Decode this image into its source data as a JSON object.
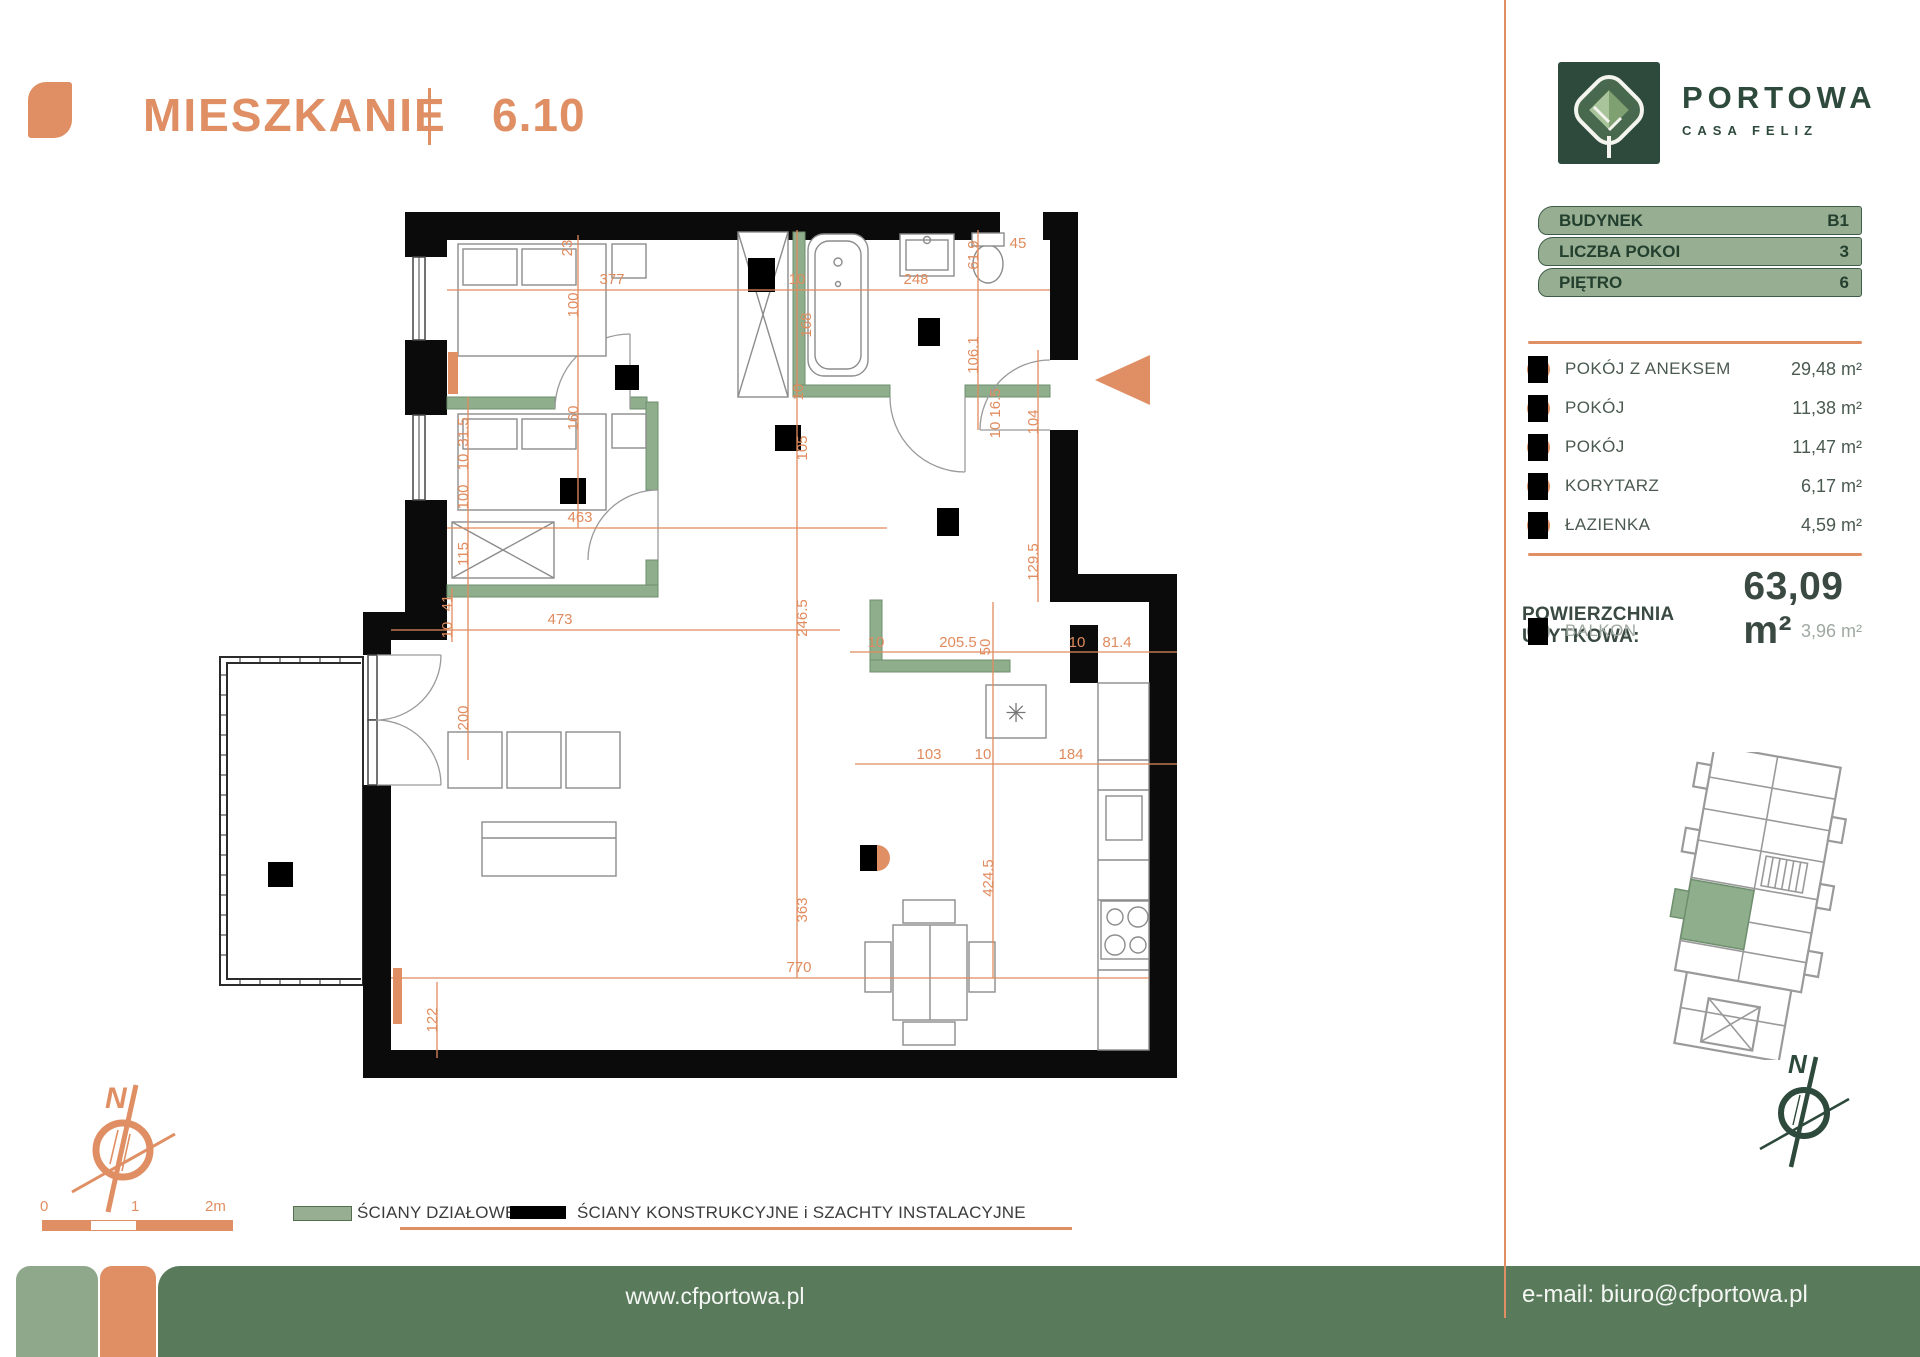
{
  "header": {
    "title": "MIESZKANIE",
    "unit": "6.10"
  },
  "logo": {
    "name": "PORTOWA",
    "subtitle": "CASA FELIZ"
  },
  "badges": {
    "items": [
      {
        "label": "BUDYNEK",
        "value": "B1"
      },
      {
        "label": "LICZBA POKOI",
        "value": "3"
      },
      {
        "label": "PIĘTRO",
        "value": "6"
      }
    ]
  },
  "rooms": {
    "items": [
      {
        "label": "POKÓJ Z ANEKSEM",
        "area": "29,48 m²"
      },
      {
        "label": "POKÓJ",
        "area": "11,38 m²"
      },
      {
        "label": "POKÓJ",
        "area": "11,47 m²"
      },
      {
        "label": "KORYTARZ",
        "area": "6,17 m²"
      },
      {
        "label": "ŁAZIENKA",
        "area": "4,59 m²"
      }
    ]
  },
  "total": {
    "label": "POWIERZCHNIA UŻYTKOWA:",
    "value": "63,09 m²"
  },
  "balcony": {
    "label": "BALKON",
    "area": "3,96 m²"
  },
  "legend": {
    "items": [
      {
        "label": "ŚCIANY DZIAŁOWE",
        "color": "#97AE92"
      },
      {
        "label": "ŚCIANY KONSTRUKCYJNE i SZACHTY INSTALACYJNE",
        "color": "#000000"
      }
    ]
  },
  "footer": {
    "website": "www.cfportowa.pl",
    "email": "e-mail: biuro@cfportowa.pl"
  },
  "compass": {
    "north": "N"
  },
  "scalebar": {
    "labels": [
      "0",
      "1",
      "2m"
    ]
  },
  "colors": {
    "accent": "#DF8F63",
    "dark_green": "#2E4A3C",
    "sage": "#97AE92",
    "footer_green": "#5A7A5C"
  },
  "floorplan": {
    "boiler_symbol": "✳",
    "dimensions": [
      {
        "t": "23",
        "x": 372,
        "y": 48,
        "v": 1
      },
      {
        "t": "377",
        "x": 412,
        "y": 84
      },
      {
        "t": "10",
        "x": 597,
        "y": 84
      },
      {
        "t": "248",
        "x": 716,
        "y": 84
      },
      {
        "t": "61.9",
        "x": 778,
        "y": 55,
        "v": 1
      },
      {
        "t": "45",
        "x": 818,
        "y": 48
      },
      {
        "t": "100",
        "x": 378,
        "y": 105,
        "v": 1
      },
      {
        "t": "160",
        "x": 378,
        "y": 218,
        "v": 1
      },
      {
        "t": "168",
        "x": 611,
        "y": 125,
        "v": 1
      },
      {
        "t": "10",
        "x": 603,
        "y": 192,
        "v": 1
      },
      {
        "t": "105",
        "x": 607,
        "y": 248,
        "v": 1
      },
      {
        "t": "106.1",
        "x": 778,
        "y": 155,
        "v": 1
      },
      {
        "t": "16.5",
        "x": 800,
        "y": 203,
        "v": 1
      },
      {
        "t": "10",
        "x": 800,
        "y": 230,
        "v": 1
      },
      {
        "t": "104",
        "x": 838,
        "y": 222,
        "v": 1
      },
      {
        "t": "129.5",
        "x": 838,
        "y": 362,
        "v": 1
      },
      {
        "t": "31.5",
        "x": 268,
        "y": 232,
        "v": 1
      },
      {
        "t": "10",
        "x": 268,
        "y": 262,
        "v": 1
      },
      {
        "t": "100",
        "x": 268,
        "y": 297,
        "v": 1
      },
      {
        "t": "115",
        "x": 268,
        "y": 354,
        "v": 1
      },
      {
        "t": "463",
        "x": 380,
        "y": 322
      },
      {
        "t": "246.5",
        "x": 607,
        "y": 418,
        "v": 1
      },
      {
        "t": "10",
        "x": 676,
        "y": 447
      },
      {
        "t": "205.5",
        "x": 758,
        "y": 447
      },
      {
        "t": "50",
        "x": 790,
        "y": 447,
        "v": 1
      },
      {
        "t": "10",
        "x": 877,
        "y": 447
      },
      {
        "t": "81.4",
        "x": 917,
        "y": 447
      },
      {
        "t": "41",
        "x": 252,
        "y": 403,
        "v": 1
      },
      {
        "t": "10",
        "x": 252,
        "y": 430,
        "v": 1
      },
      {
        "t": "473",
        "x": 360,
        "y": 424
      },
      {
        "t": "103",
        "x": 729,
        "y": 559
      },
      {
        "t": "10",
        "x": 783,
        "y": 559
      },
      {
        "t": "184",
        "x": 871,
        "y": 559
      },
      {
        "t": "200",
        "x": 268,
        "y": 518,
        "v": 1
      },
      {
        "t": "363",
        "x": 607,
        "y": 710,
        "v": 1
      },
      {
        "t": "424.5",
        "x": 793,
        "y": 678,
        "v": 1
      },
      {
        "t": "770",
        "x": 599,
        "y": 772
      },
      {
        "t": "122",
        "x": 237,
        "y": 820,
        "v": 1
      }
    ]
  }
}
